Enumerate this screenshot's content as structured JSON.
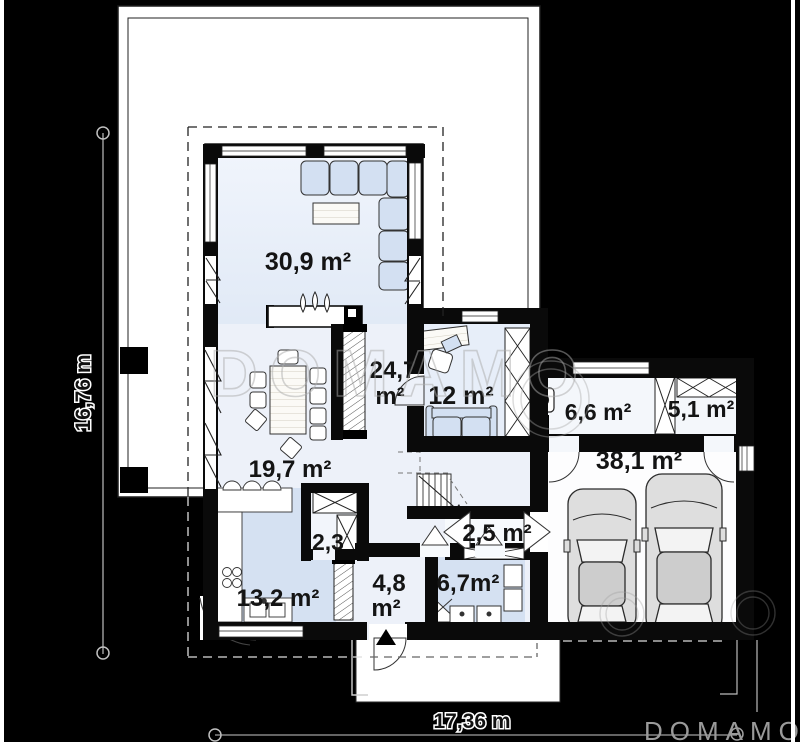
{
  "plan": {
    "rooms": {
      "living": "30,9 m²",
      "hall_line1": "24,7",
      "hall_line2": "m²",
      "bedroom": "12 m²",
      "boiler": "6,6 m²",
      "storage": "5,1 m²",
      "garage": "38,1 m²",
      "dining": "19,7 m²",
      "wc": "2,3",
      "kitchen": "13,2 m²",
      "entry_line1": "4,8",
      "entry_line2": "m²",
      "bathroom": "6,7m²",
      "corridor": "2,5 m²"
    },
    "dimensions": {
      "height": "16,76 m",
      "width": "17,36 m"
    },
    "watermark_text": "DOMAMO",
    "logo_text": "DOMAMO",
    "colors": {
      "background": "#000000",
      "terrace": "#ffffff",
      "floor": "#edf1f9",
      "accent_blue": "#d5e1f2",
      "wall": "#0a0a0a",
      "watermark": "#9a9a9a"
    }
  }
}
